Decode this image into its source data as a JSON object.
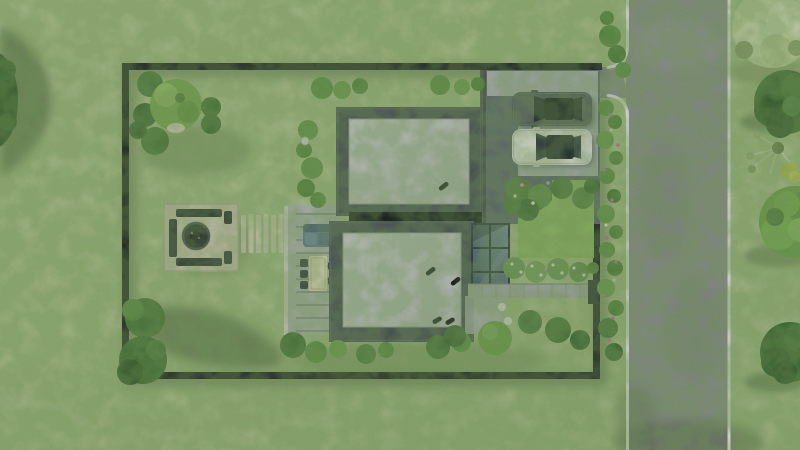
{
  "scene": {
    "description": "Top-down 3D architectural rendering of a fenced residential plot with two flat-roof modern buildings joined by a glass canopy, a pergola terrace with outdoor furniture, a stone fire-pit patio with benches, a stepping-stone path, a gravel driveway with a dark car and a white car, ornamental garden beds, and a vertical asphalt road with grass and trees on the right"
  },
  "colors": {
    "grass": "#aec28f",
    "grass_light": "#bccf9d",
    "road": "#8f9193",
    "road_line": "#eceeec",
    "fence": "#171c21",
    "building_parapet": "#474d57",
    "building_roof": "#c6c9c9",
    "building_wall": "#394049",
    "connector_roof": "#10141a",
    "gravel": "#5e6773",
    "concrete_pad": "#b7bbc0",
    "terrace": "#b7bbb9",
    "path_light": "#d9dad4",
    "walkway": "#a9afad",
    "canopy_frame": "#232c37",
    "canopy_glass": "#5b7089",
    "stone_patio": "#d7cfbd",
    "stepping_stone": "#dcd5c3",
    "bench": "#262b31",
    "fire_bowl": "#23272c",
    "sofa_blue": "#64789a",
    "table_cream": "#ece4c6",
    "chair_dark": "#2e343b",
    "car_dark_body": "#51585e",
    "car_white_body": "#e9e9e6",
    "car_glass": "#1c232c",
    "shrub_green": "#5d9146",
    "tree_dark": "#3c6833",
    "tree_bright": "#6ca248",
    "tree_pale": "#c9d7a8",
    "flower_pink": "#c5709e",
    "lamp_white": "#eef0ea",
    "shadow_green": "#24381c"
  }
}
